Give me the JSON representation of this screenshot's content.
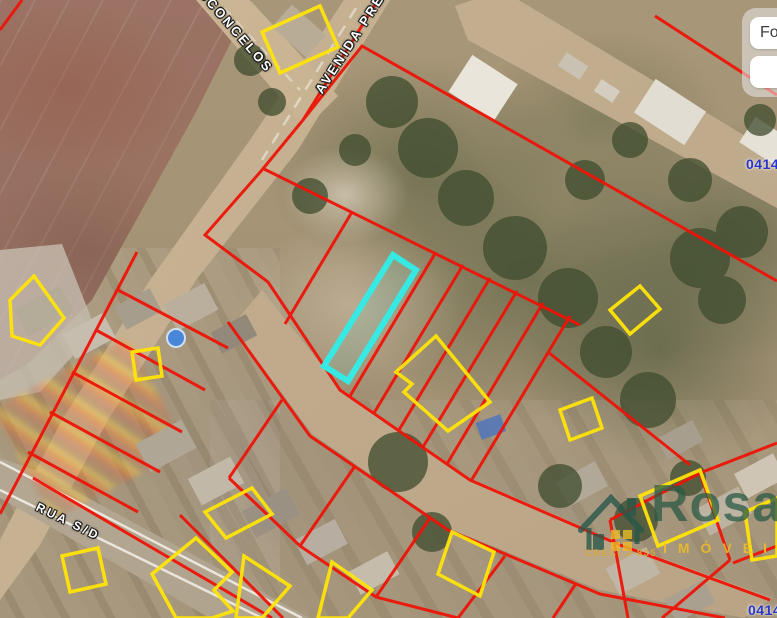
{
  "map": {
    "street_labels": [
      {
        "name": "vasconcelos",
        "text": "VASCONCELOS"
      },
      {
        "name": "avenida-presidente",
        "text": "AVENIDA PRESIDENTE"
      },
      {
        "name": "rua-sd",
        "text": "RUA  S/D"
      }
    ],
    "parcel_numbers": [
      {
        "text": "0414"
      },
      {
        "text": "04145"
      }
    ]
  },
  "panel": {
    "button_text": "Fo"
  },
  "watermark": {
    "brand": "Rosa",
    "line1": "IMÓVEIS",
    "creci": "CRECI J-835"
  },
  "colors": {
    "parcel-red": "#ee1408",
    "parcel-yellow": "#ffe408",
    "highlight-cyan": "#36e9e3",
    "number-blue": "#2a35c8",
    "logo-green": "#2a5a44",
    "logo-yellow": "#edbd2a"
  }
}
